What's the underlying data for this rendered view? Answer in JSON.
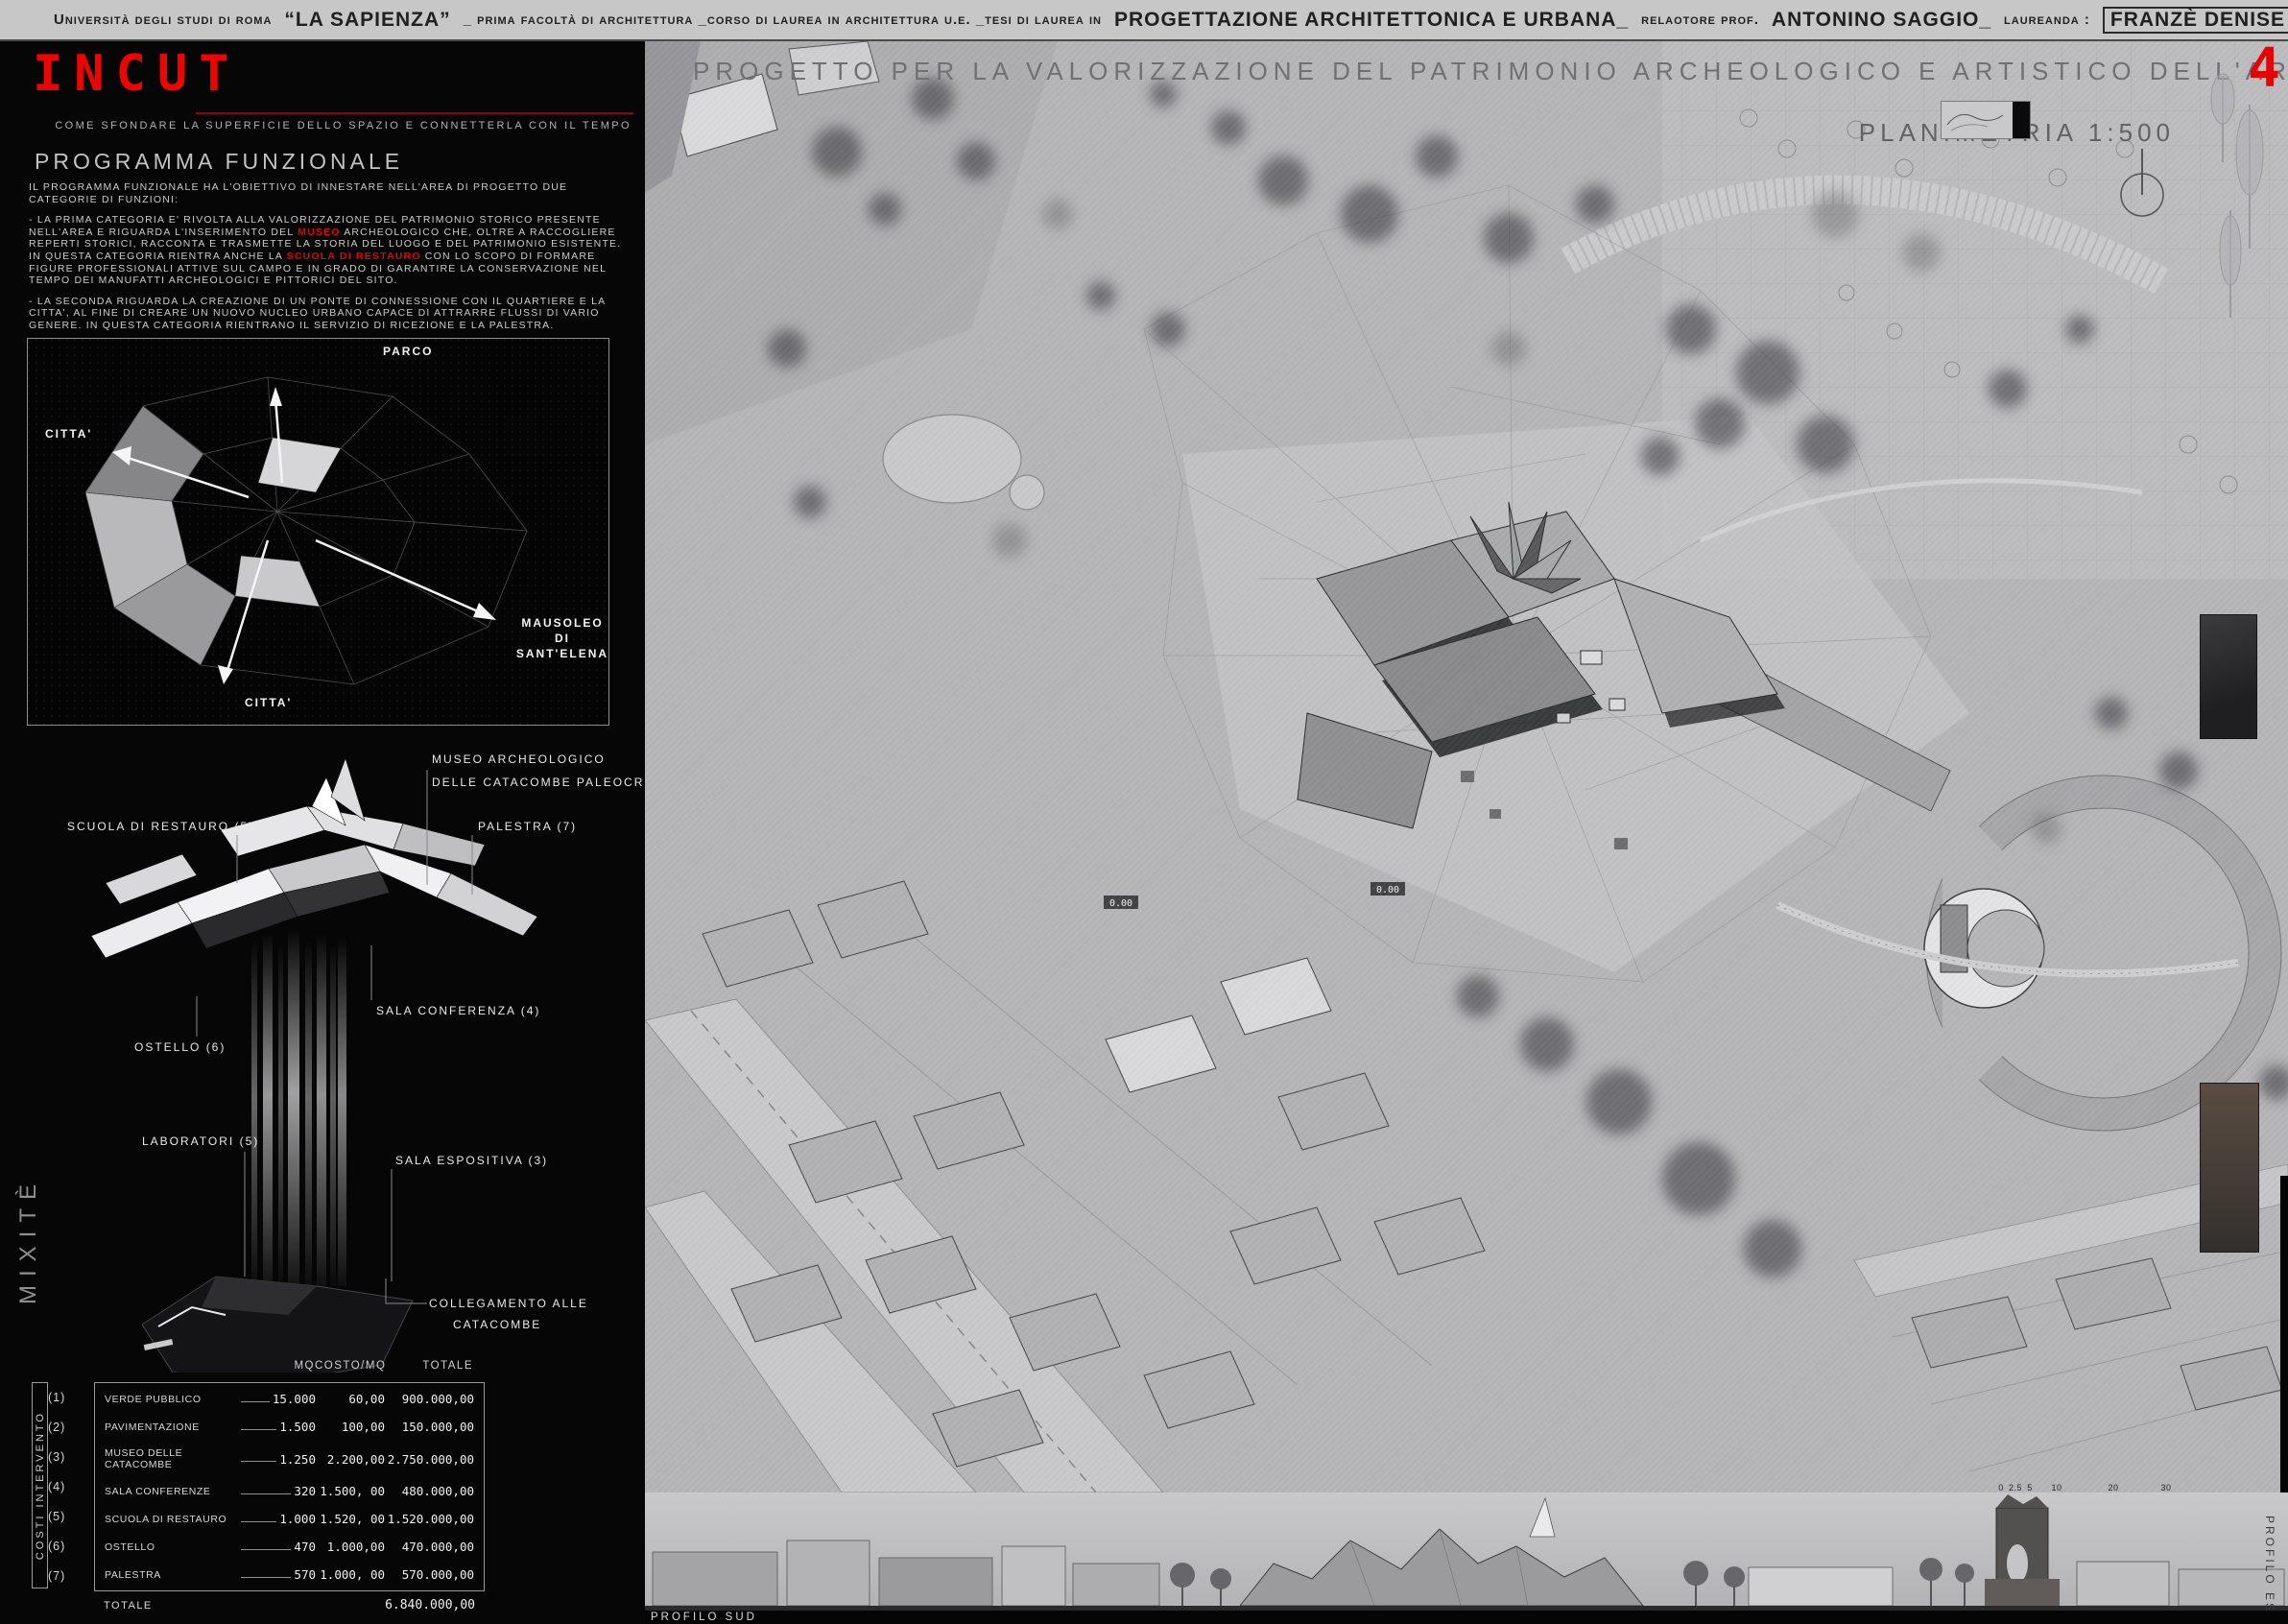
{
  "header": {
    "s1": "Università degli studi di roma",
    "s2": "“LA SAPIENZA”",
    "s3": "_ prima facoltà di architettura _corso di laurea in architettura u.e. _tesi di laurea in",
    "s4": "PROGETTAZIONE ARCHITETTONICA E URBANA_",
    "s5": "relaotore prof.",
    "s6": "ANTONINO SAGGIO_",
    "s7": "laureanda :",
    "s8": "FRANZÈ DENISE"
  },
  "sidebar": {
    "logo": "INCUT",
    "tagline": "COME SFONDARE LA SUPERFICIE DELLO SPAZIO E CONNETTERLA CON IL TEMPO",
    "programma": {
      "title": "PROGRAMMA FUNZIONALE",
      "p1": "IL PROGRAMMA FUNZIONALE HA L'OBIETTIVO DI INNESTARE NELL'AREA DI PROGETTO DUE CATEGORIE DI FUNZIONI:",
      "p2_pre": "- LA PRIMA CATEGORIA E' RIVOLTA ALLA VALORIZZAZIONE DEL PATRIMONIO STORICO PRESENTE NELL'AREA E RIGUARDA L'INSERIMENTO DEL ",
      "p2_red": "MUSEO",
      "p2_post": " ARCHEOLOGICO CHE, OLTRE A RACCOGLIERE REPERTI STORICI, RACCONTA E TRASMETTE LA STORIA DEL LUOGO E DEL PATRIMONIO ESISTENTE.",
      "p3_pre": "IN QUESTA CATEGORIA RIENTRA ANCHE LA ",
      "p3_red": "SCUOLA DI RESTAURO",
      "p3_post": " CON LO SCOPO DI FORMARE FIGURE PROFESSIONALI ATTIVE SUL CAMPO E IN GRADO DI GARANTIRE LA CONSERVAZIONE NEL TEMPO DEI MANUFATTI ARCHEOLOGICI E PITTORICI DEL SITO.",
      "p4": "- LA SECONDA RIGUARDA LA CREAZIONE DI UN PONTE DI CONNESSIONE CON IL QUARTIERE E LA CITTA', AL FINE DI CREARE UN NUOVO NUCLEO URBANO CAPACE DI ATTRARRE FLUSSI DI VARIO GENERE. IN QUESTA CATEGORIA RIENTRANO IL SERVIZIO DI RICEZIONE E LA PALESTRA."
    },
    "map": {
      "parco": "PARCO",
      "citta_left": "CITTA'",
      "mausoleo_1": "MAUSOLEO",
      "mausoleo_2": "DI",
      "mausoleo_3": "SANT'ELENA",
      "citta_bottom": "CITTA'"
    },
    "axon": {
      "museo_1": "MUSEO ARCHEOLOGICO",
      "museo_2": "DELLE CATACOMBE PALEOCRISTIANE (3)",
      "scuola": "SCUOLA DI RESTAURO (5)",
      "palestra": "PALESTRA (7)",
      "sala_conferenza": "SALA CONFERENZA (4)",
      "ostello": "OSTELLO (6)",
      "laboratori": "LABORATORI (5)",
      "sala_espositiva": "SALA ESPOSITIVA (3)",
      "collegamento_1": "COLLEGAMENTO ALLE",
      "collegamento_2": "CATACOMBE",
      "mixite": "MIXITÈ"
    },
    "costs": {
      "vertical_label": "COSTI INTERVENTO",
      "col_mq": "MQ",
      "col_costo": "COSTO/MQ",
      "col_totale": "TOTALE",
      "rows": [
        {
          "num": "(1)",
          "name": "VERDE PUBBLICO",
          "mq": "15.000",
          "costo": "60,00",
          "totale": "900.000,00"
        },
        {
          "num": "(2)",
          "name": "PAVIMENTAZIONE",
          "mq": "1.500",
          "costo": "100,00",
          "totale": "150.000,00"
        },
        {
          "num": "(3)",
          "name": "MUSEO DELLE CATACOMBE",
          "mq": "1.250",
          "costo": "2.200,00",
          "totale": "2.750.000,00"
        },
        {
          "num": "(4)",
          "name": "SALA CONFERENZE",
          "mq": "320",
          "costo": "1.500, 00",
          "totale": "480.000,00"
        },
        {
          "num": "(5)",
          "name": "SCUOLA DI RESTAURO",
          "mq": "1.000",
          "costo": "1.520, 00",
          "totale": "1.520.000,00"
        },
        {
          "num": "(6)",
          "name": "OSTELLO",
          "mq": "470",
          "costo": "1.000,00",
          "totale": "470.000,00"
        },
        {
          "num": "(7)",
          "name": "PALESTRA",
          "mq": "570",
          "costo": "1.000, 00",
          "totale": "570.000,00"
        }
      ],
      "total_label": "TOTALE",
      "total_value": "6.840.000,00"
    }
  },
  "main": {
    "title": "PROGETTO PER LA VALORIZZAZIONE DEL PATRIMONIO ARCHEOLOGICO E ARTISTICO DELL'AREA “AD DUAS LAUROS”",
    "page_number": "4",
    "plan_label": "PLANIMETRIA 1:500",
    "profile_south": "PROFILO SUD",
    "profile_east": "PROFILO EST",
    "scale_ticks": [
      "0",
      "2.5",
      "5",
      "10",
      "20",
      "30"
    ],
    "level_markers": [
      "0.00",
      "0.00"
    ]
  },
  "colors": {
    "accent_red": "#e60200",
    "topbar_bg": "#c7c7c7",
    "sidebar_bg": "#060606",
    "plan_bg": "#b6b6b9"
  }
}
